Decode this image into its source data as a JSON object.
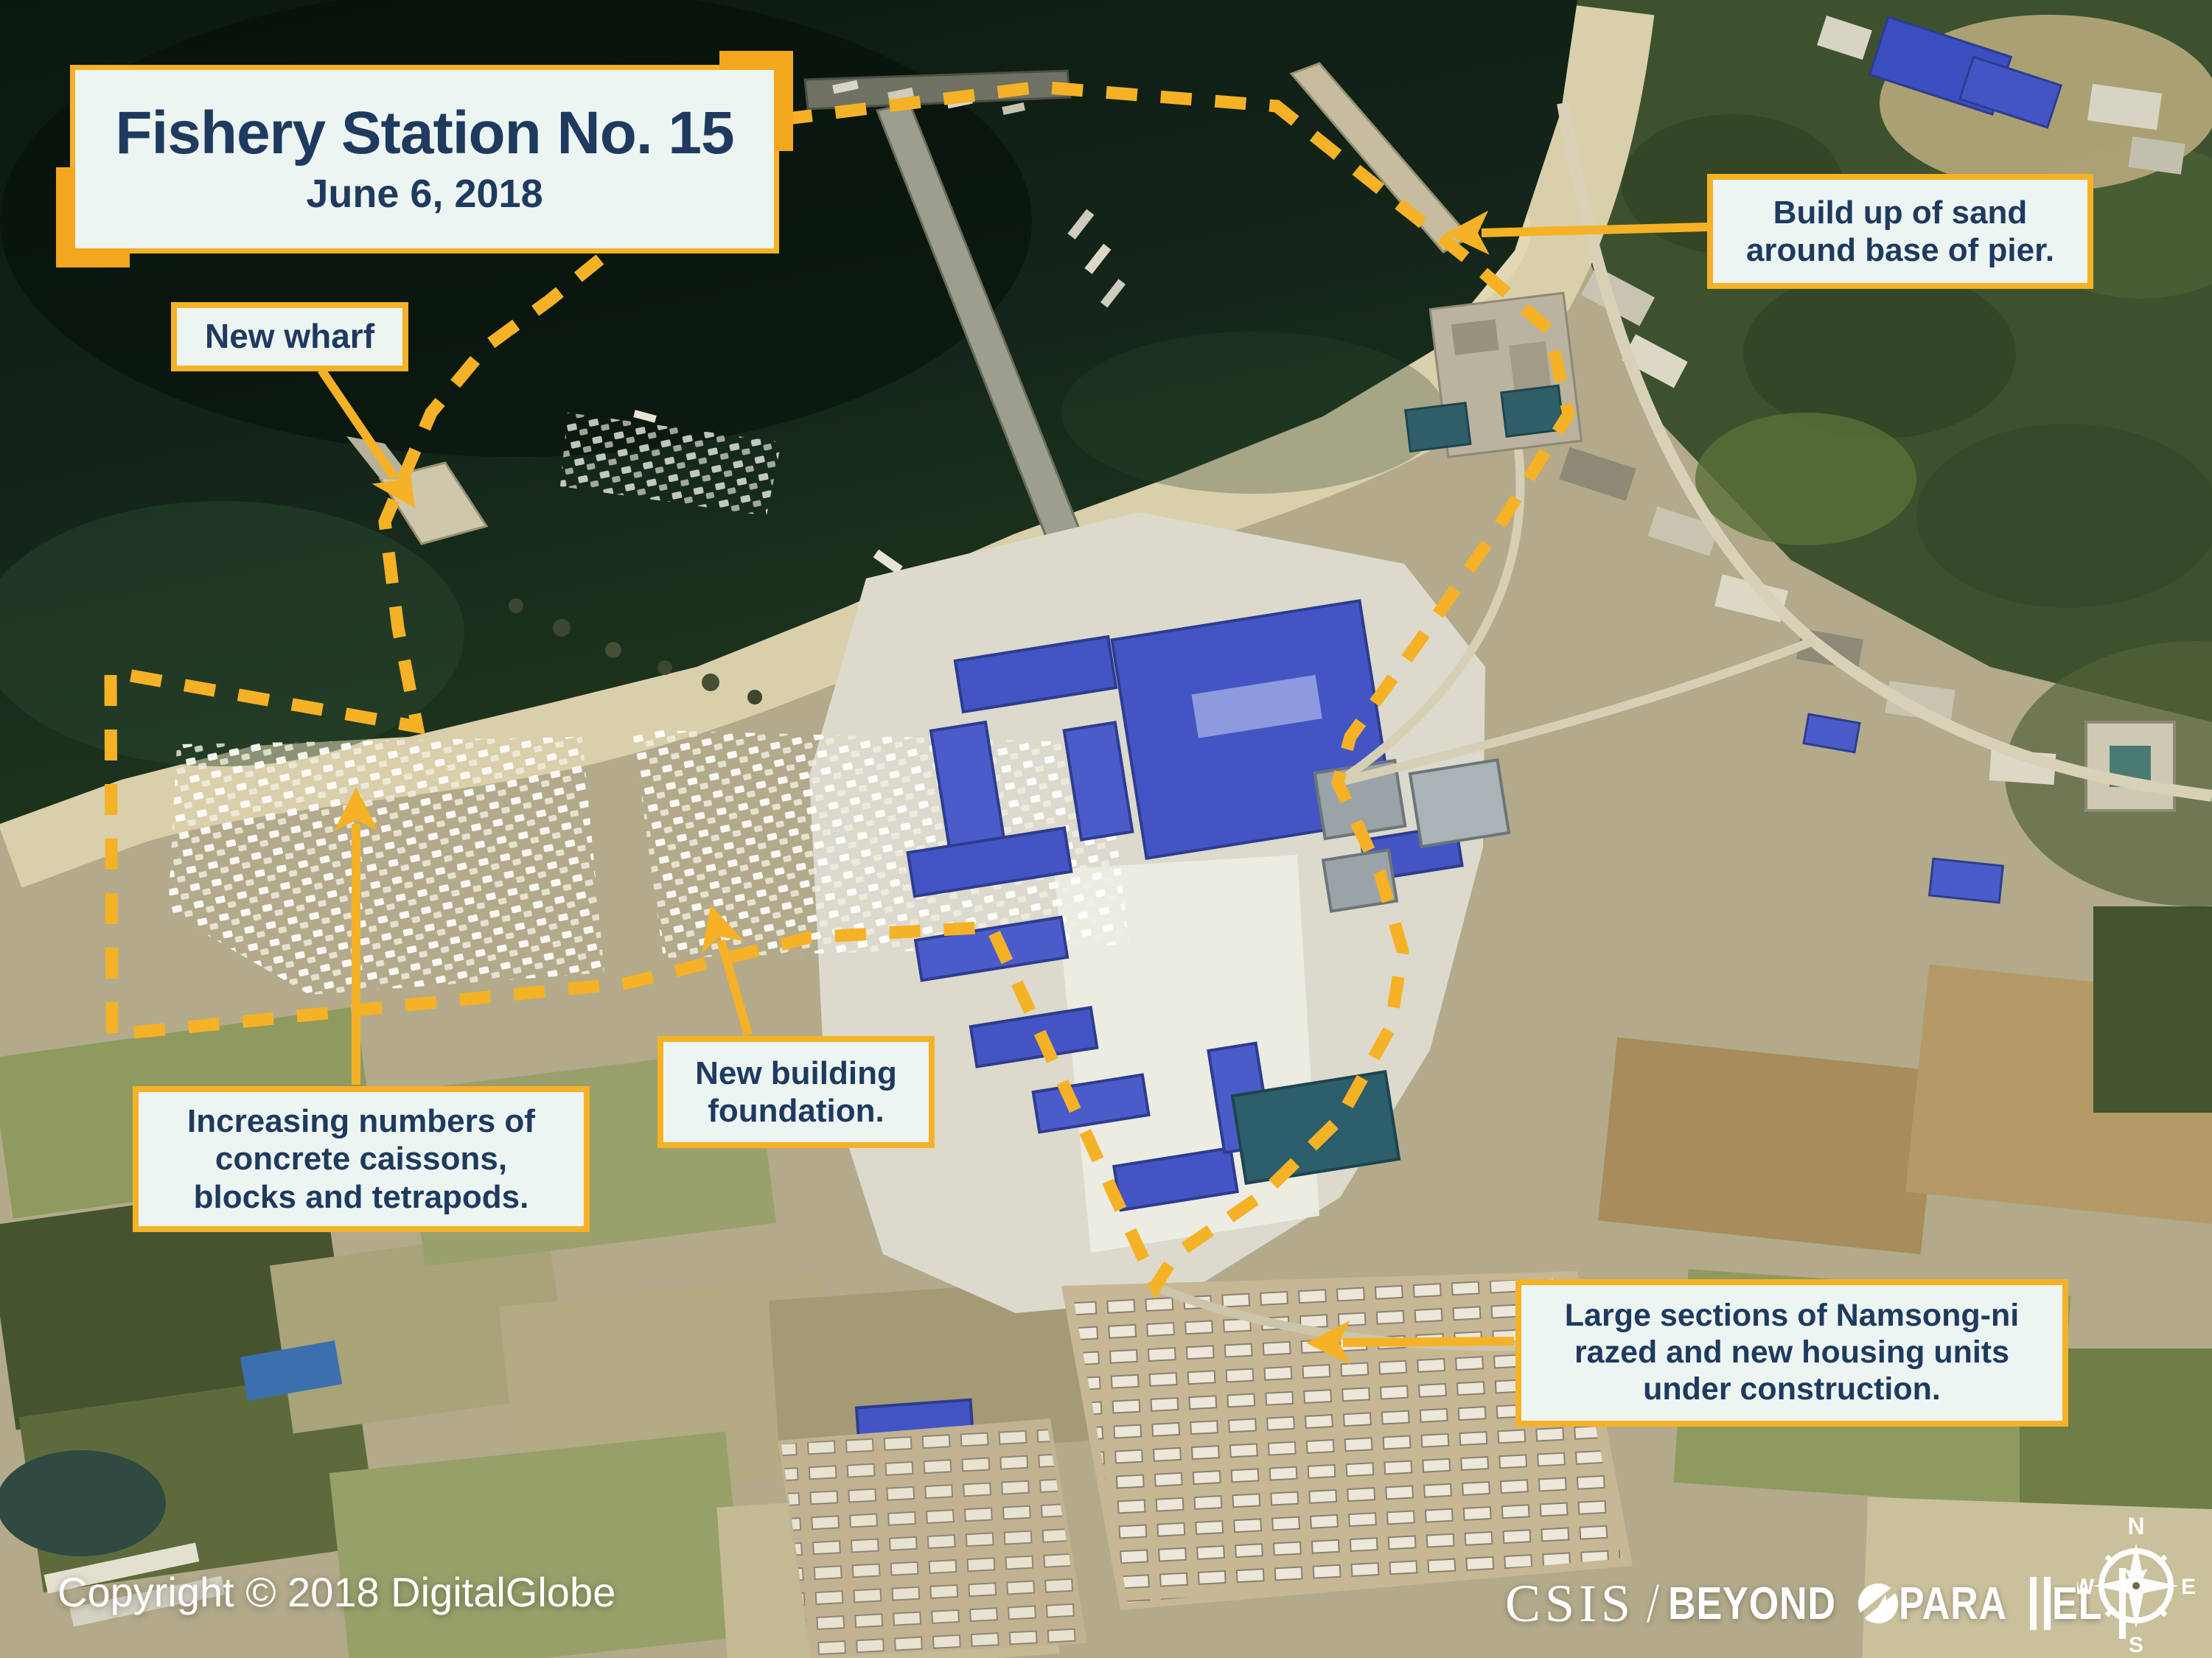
{
  "title_box": {
    "title": "Fishery Station No. 15",
    "date": "June 6, 2018"
  },
  "annotations": [
    {
      "id": "new-wharf",
      "lines": [
        "New wharf"
      ]
    },
    {
      "id": "sand-buildup",
      "lines": [
        "Build up of sand",
        "around base of pier."
      ]
    },
    {
      "id": "caissons",
      "lines": [
        "Increasing numbers of",
        "concrete caissons,",
        "blocks and tetrapods."
      ]
    },
    {
      "id": "foundation",
      "lines": [
        "New building",
        "foundation."
      ]
    },
    {
      "id": "namsong",
      "lines": [
        "Large sections of Namsong-ni",
        "razed and new housing units",
        "under construction."
      ]
    }
  ],
  "footer": {
    "copyright": "Copyright © 2018 DigitalGlobe"
  },
  "logo": {
    "csis": "CSIS",
    "slash": "/",
    "beyond": "BEYOND",
    "para": "PARA",
    "el": "EL"
  },
  "compass": {
    "n": "N",
    "e": "E",
    "s": "S",
    "w": "W"
  },
  "colors": {
    "accent_yellow": "#F5B226",
    "corner_accent": "#F2A71F",
    "label_background": "#EDF5F2",
    "label_text_navy": "#1E3A5F",
    "footer_white": "#FFFFFF"
  }
}
